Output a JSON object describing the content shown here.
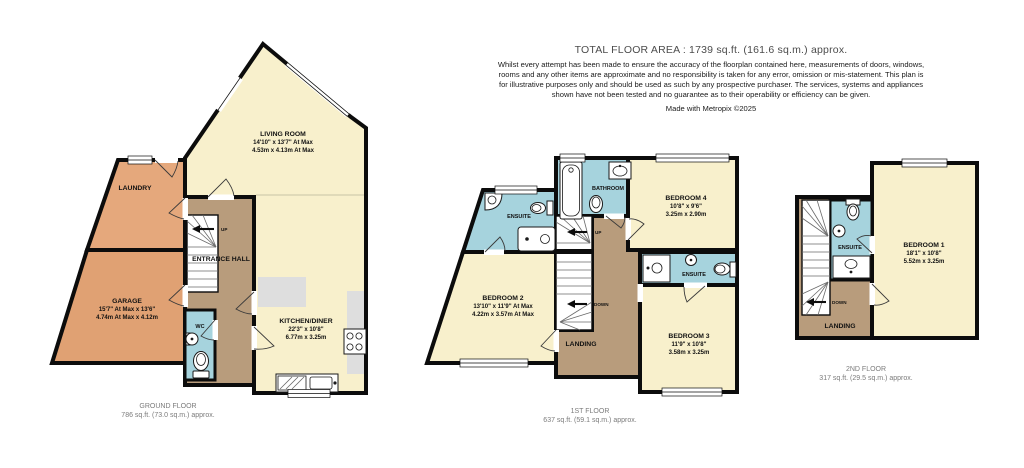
{
  "header": {
    "title": "TOTAL FLOOR AREA : 1739 sq.ft. (161.6 sq.m.) approx.",
    "disclaimer": "Whilst every attempt has been made to ensure the accuracy of the floorplan contained here, measurements of doors, windows, rooms and any other items are approximate and no responsibility is taken for any error, omission or mis-statement. This plan is for illustrative purposes only and should be used as such by any prospective purchaser. The services, systems and appliances shown have not been tested and no guarantee as to their operability or efficiency can be given.",
    "credit": "Made with Metropix ©2025"
  },
  "floors": {
    "ground": {
      "label": "GROUND FLOOR",
      "area": "786 sq.ft. (73.0 sq.m.) approx.",
      "rooms": {
        "living": {
          "name": "LIVING ROOM",
          "imperial": "14'10\" x 13'7\" At Max",
          "metric": "4.53m x 4.13m At Max"
        },
        "kitchen": {
          "name": "KITCHEN/DINER",
          "imperial": "22'3\" x 10'8\"",
          "metric": "6.77m x 3.25m"
        },
        "garage": {
          "name": "GARAGE",
          "imperial": "15'7\" At Max x 13'6\"",
          "metric": "4.74m At Max x 4.12m"
        },
        "laundry": {
          "name": "LAUNDRY"
        },
        "hall": {
          "name": "ENTRANCE HALL"
        },
        "wc": {
          "name": "WC"
        },
        "up": "UP"
      }
    },
    "first": {
      "label": "1ST FLOOR",
      "area": "637 sq.ft. (59.1 sq.m.) approx.",
      "rooms": {
        "bedroom2": {
          "name": "BEDROOM 2",
          "imperial": "13'10\" x 11'9\" At Max",
          "metric": "4.22m x 3.57m At Max"
        },
        "bedroom3": {
          "name": "BEDROOM 3",
          "imperial": "11'9\" x 10'8\"",
          "metric": "3.58m x 3.25m"
        },
        "bedroom4": {
          "name": "BEDROOM 4",
          "imperial": "10'8\" x 9'6\"",
          "metric": "3.25m x 2.90m"
        },
        "bathroom": {
          "name": "BATHROOM"
        },
        "ensuite_left": {
          "name": "ENSUITE"
        },
        "ensuite_right": {
          "name": "ENSUITE"
        },
        "landing": {
          "name": "LANDING"
        },
        "up": "UP",
        "down": "DOWN"
      }
    },
    "second": {
      "label": "2ND FLOOR",
      "area": "317 sq.ft. (29.5 sq.m.) approx.",
      "rooms": {
        "bedroom1": {
          "name": "BEDROOM 1",
          "imperial": "18'1\" x 10'8\"",
          "metric": "5.52m x 3.25m"
        },
        "ensuite": {
          "name": "ENSUITE"
        },
        "landing": {
          "name": "LANDING"
        },
        "down": "DOWN"
      }
    }
  },
  "colors": {
    "room_cream": "#F8F0CC",
    "room_orange": "#E5A87C",
    "room_orange_dark": "#E0A173",
    "room_brown": "#B89C7C",
    "room_blue": "#A6D3DD",
    "wall": "#0C0C0C",
    "counter_grey": "#DEDEDE"
  }
}
